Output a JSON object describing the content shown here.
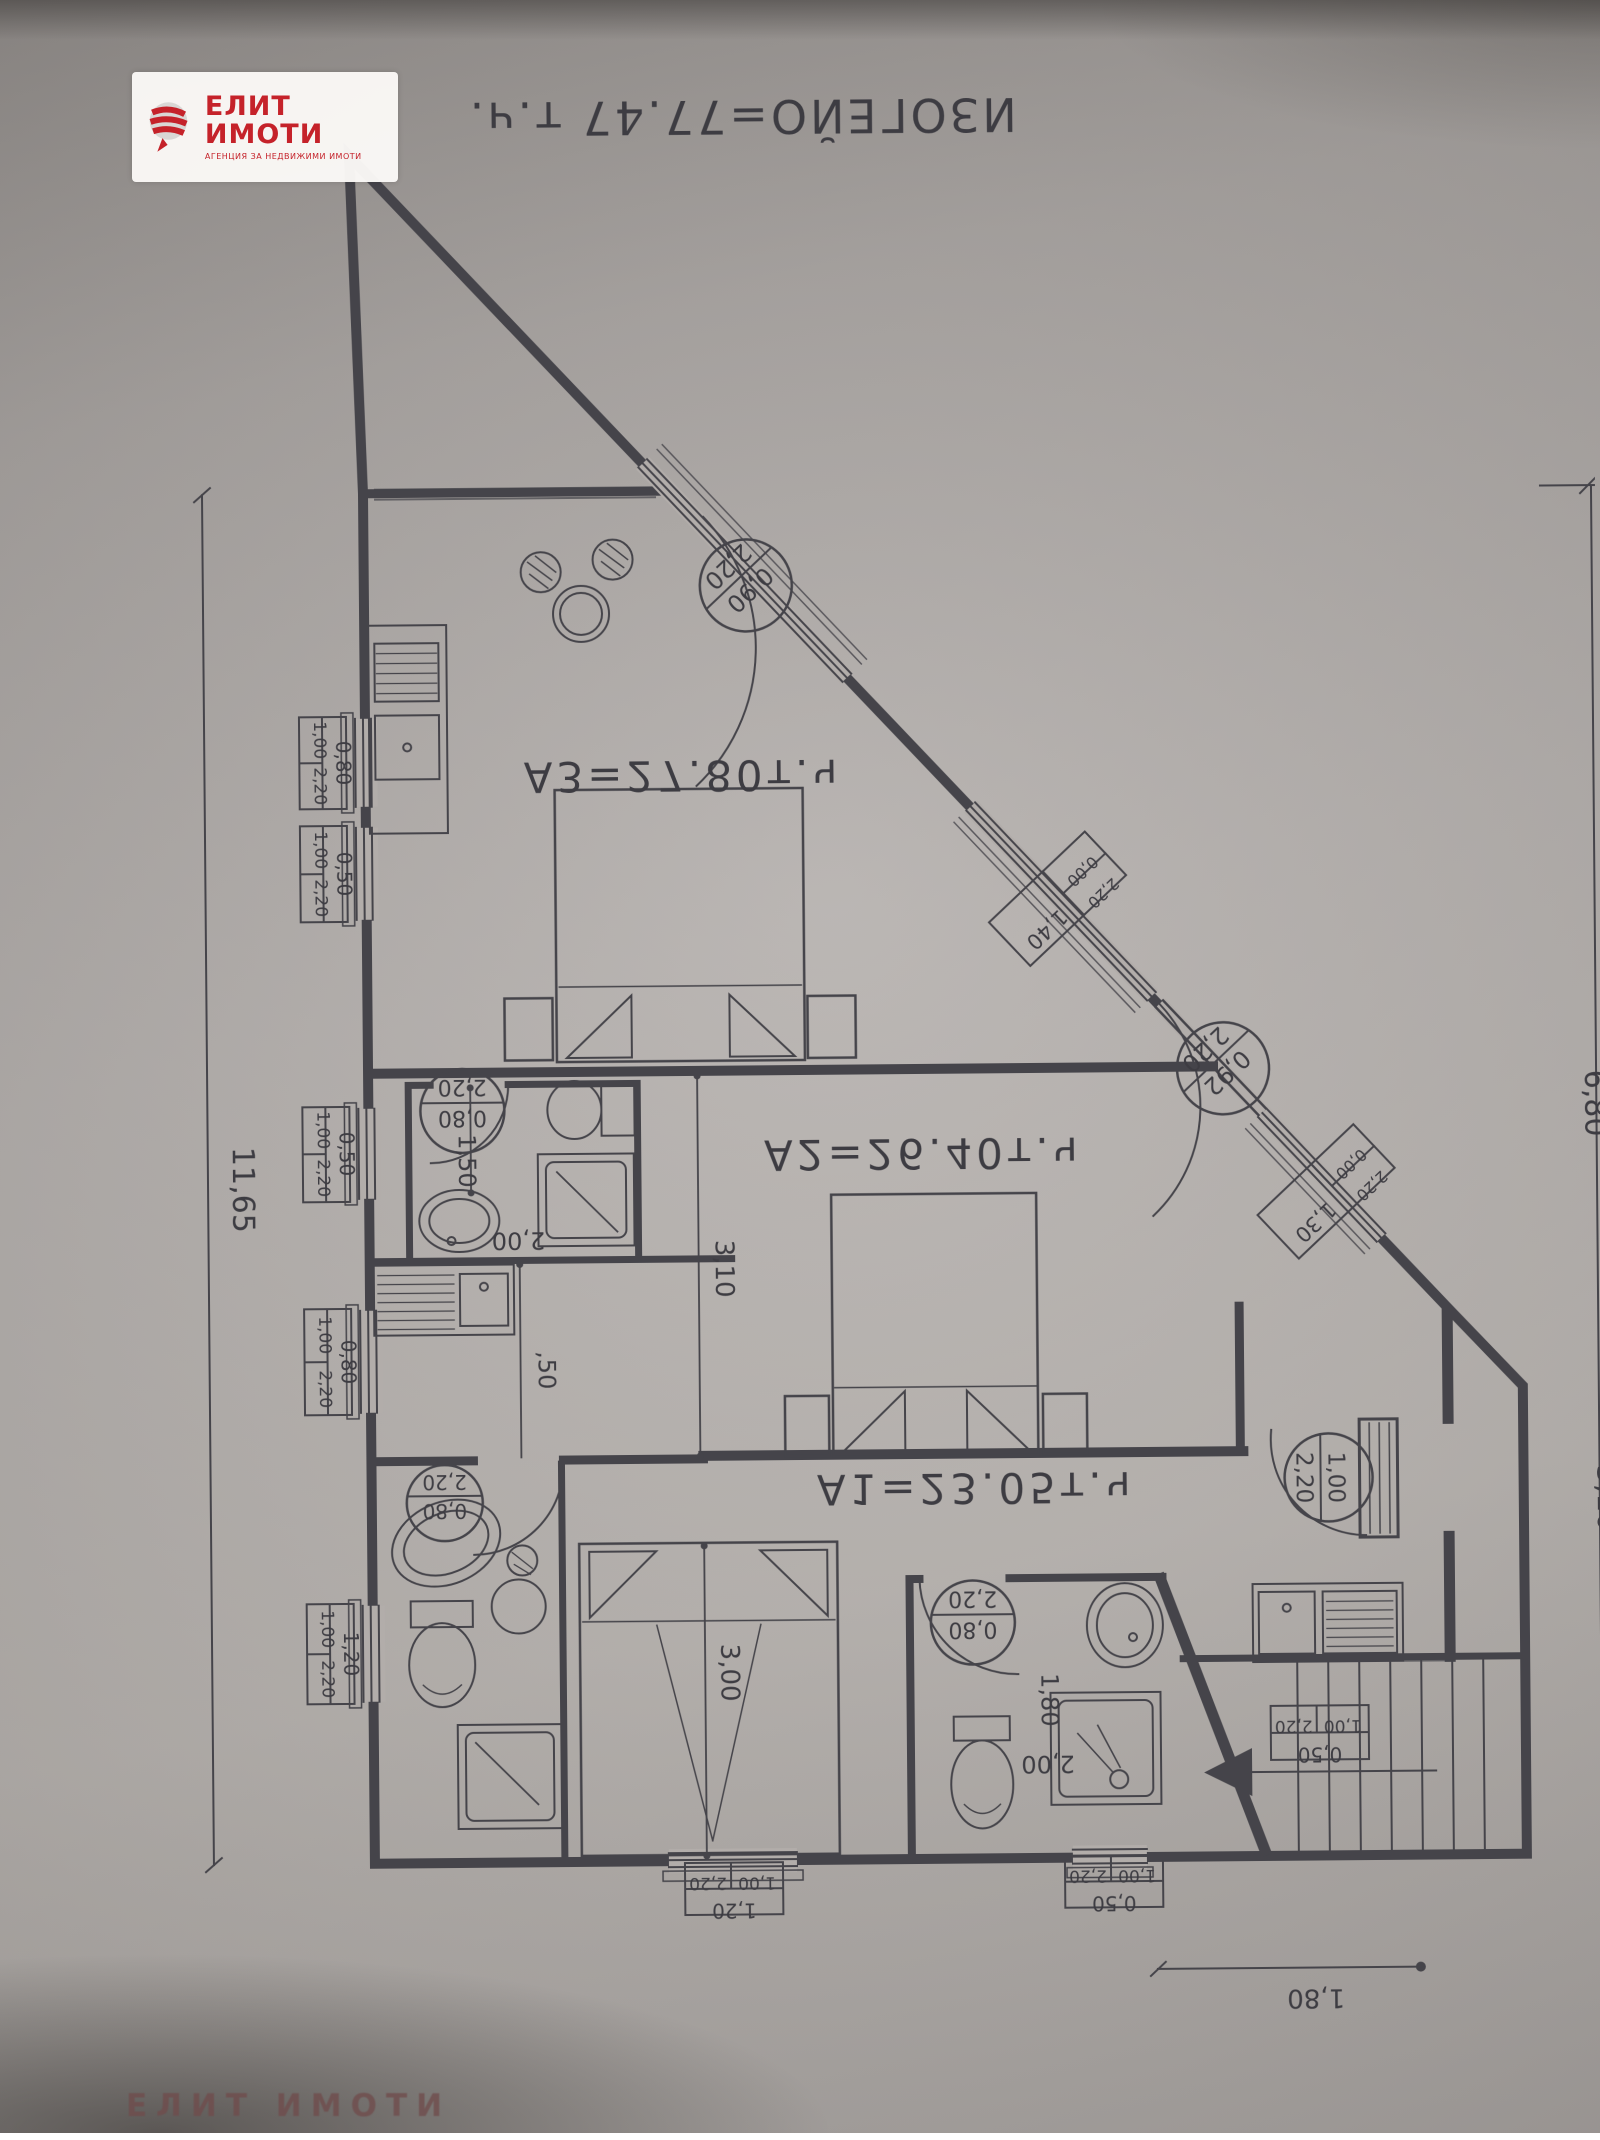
{
  "logo": {
    "title": "ЕЛИТ ИМОТИ",
    "subtitle": "АГЕНЦИЯ ЗА НЕДВИЖИМИ ИМОТИ"
  },
  "watermark": "ЕЛИТ ИМОТИ",
  "plan": {
    "total_area_label": "ИЗОГЕЙО=77.47 т.ч.",
    "apartment_labels": {
      "a3": "А3=27.80т.ч",
      "a2": "А2=26.40т.ч",
      "a1": "А1=23.05т.ч"
    },
    "overall_dimensions": {
      "left": "11,65",
      "right_upper": "6,80",
      "right_lower": "3,10",
      "bottom": "1,80"
    },
    "window_tags_left": [
      {
        "width": "0,80",
        "sill": "1,00",
        "height": "2,20"
      },
      {
        "width": "0,50",
        "sill": "1,00",
        "height": "2,20"
      },
      {
        "width": "0,50",
        "sill": "1,00",
        "height": "2,20"
      },
      {
        "width": "0,80",
        "sill": "1,00",
        "height": "2,20"
      },
      {
        "width": "1,20",
        "sill": "1,00",
        "height": "2,20"
      }
    ],
    "window_tags_bottom": [
      {
        "width": "1,20",
        "sill": "1,00",
        "height": "2,20"
      },
      {
        "width": "0,50",
        "sill": "1,00",
        "height": "2,20"
      },
      {
        "width": "0,50",
        "sill": "1,00",
        "height": "2,20"
      }
    ],
    "window_tags_diagonal": [
      {
        "width": "1,40",
        "sill": "0,00",
        "height": "2,20"
      },
      {
        "width": "1,30",
        "sill": "0,00",
        "height": "2,20"
      }
    ],
    "door_tags_diagonal": [
      {
        "width": "0,90",
        "height": "2,20"
      },
      {
        "width": "0,92",
        "height": "2,20"
      }
    ],
    "door_tag_entry": {
      "width": "1,00",
      "height": "2,20"
    },
    "door_tags_interior": [
      {
        "width": "0,80",
        "height": "2,20"
      },
      {
        "width": "0,80",
        "height": "2,20"
      },
      {
        "width": "0,80",
        "height": "2,20"
      }
    ],
    "room_dimensions": {
      "bath_a2_width": "1,50",
      "bath_a2_depth": "2,00",
      "a2_room_length": "3,10",
      "kitchen_offset": ",50",
      "a1_room_length": "3,00",
      "bath_a1_width": "1,80",
      "bath_a1_depth": "2,00"
    }
  }
}
